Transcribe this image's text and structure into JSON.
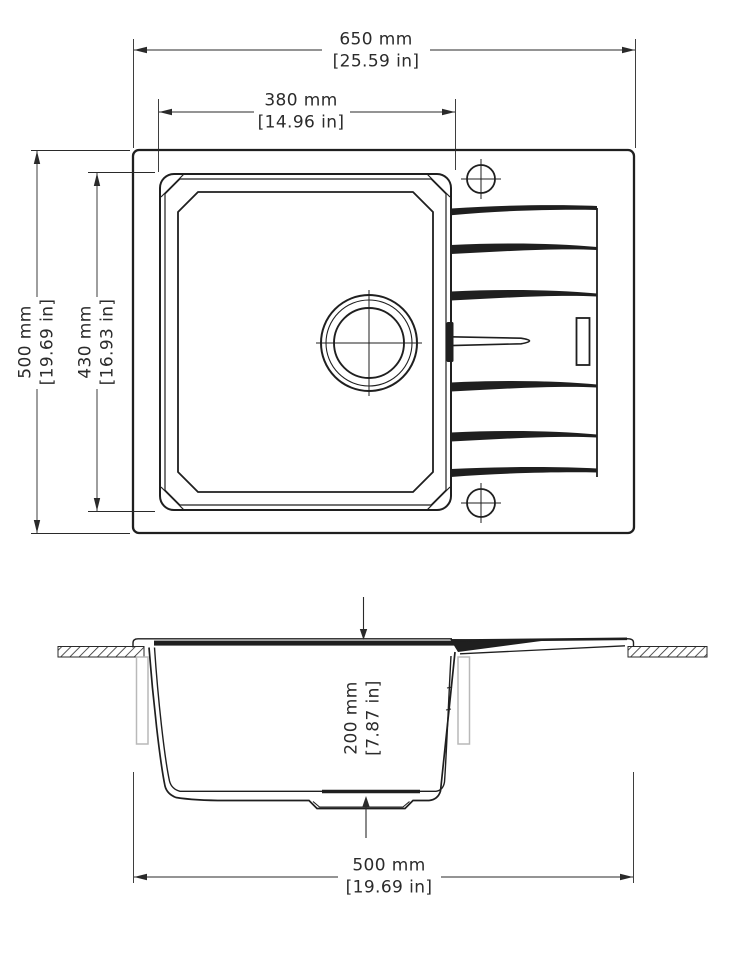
{
  "drawing": {
    "type": "technical-drawing",
    "subject": "Kitchen sink with drainboard — top view and section view"
  },
  "colors": {
    "line": "#1f1f1f",
    "dim": "#2a2a2a",
    "panel": "#b9b9b9",
    "bg": "#ffffff",
    "text": "#2b2b2b"
  },
  "top_view": {
    "dims": {
      "overall_width": {
        "mm": "650 mm",
        "inch": "[25.59 in]"
      },
      "bowl_width": {
        "mm": "380 mm",
        "inch": "[14.96 in]"
      },
      "overall_depth": {
        "mm": "500 mm",
        "inch": "[19.69 in]"
      },
      "bowl_depth": {
        "mm": "430 mm",
        "inch": "[16.93 in]"
      }
    }
  },
  "section_view": {
    "dims": {
      "bowl_height": {
        "mm": "200 mm",
        "inch": "[7.87 in]"
      },
      "base_width": {
        "mm": "500 mm",
        "inch": "[19.69 in]"
      }
    }
  }
}
